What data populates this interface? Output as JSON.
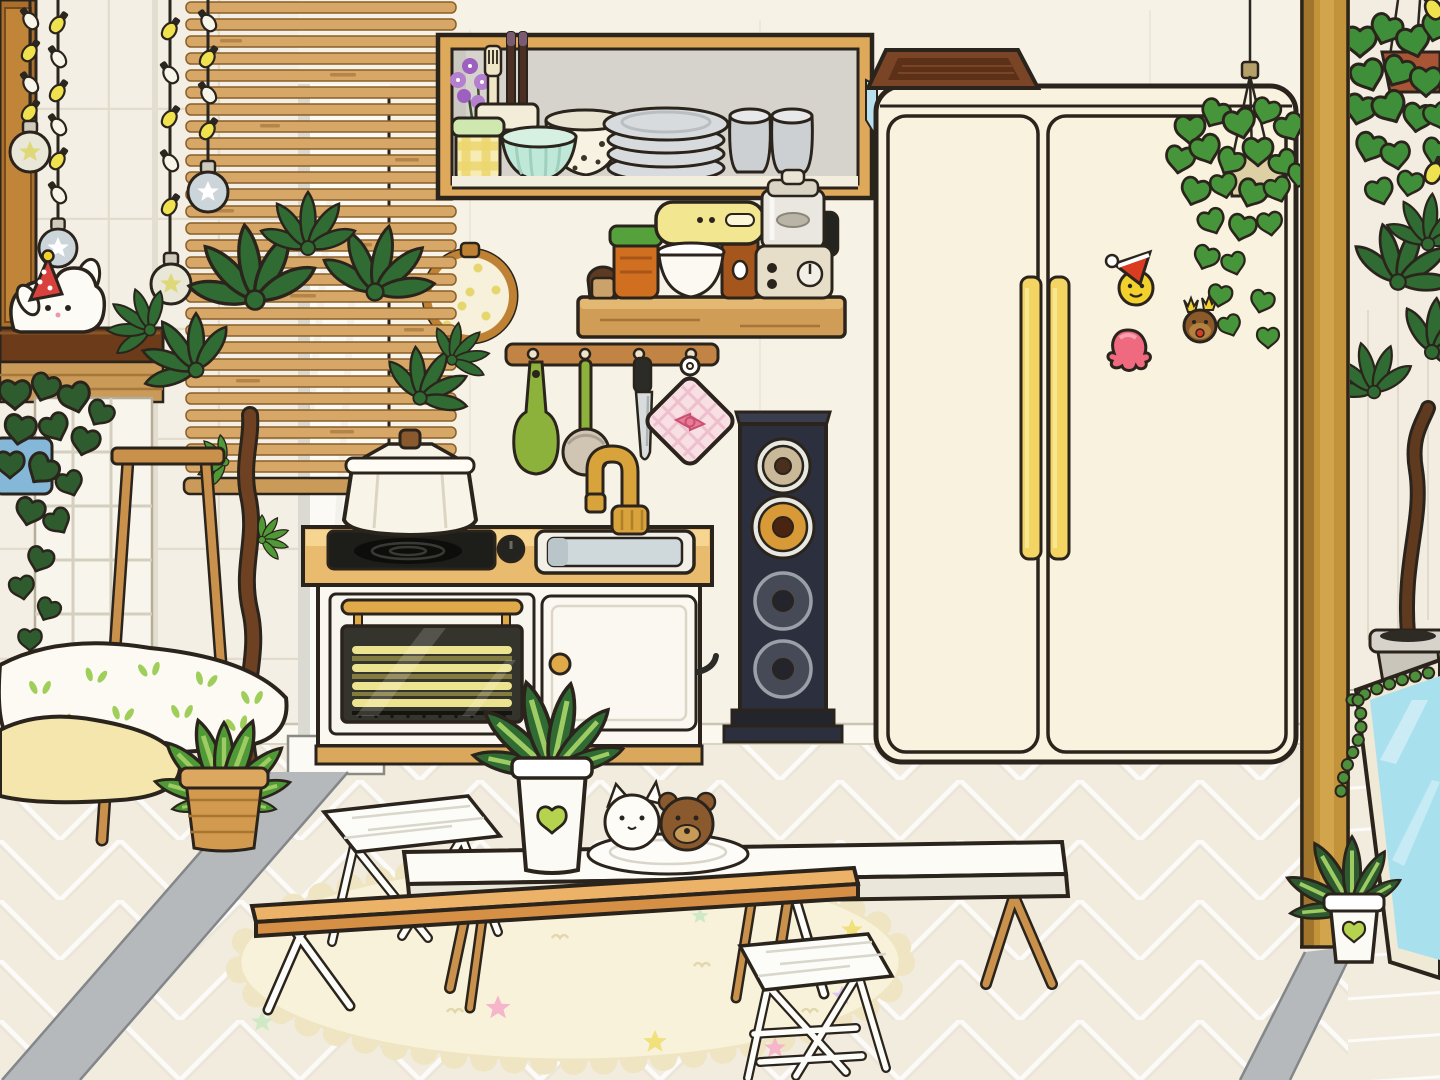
{
  "scene": {
    "title": "Toca-style cartoon kitchen room",
    "type": "game-room-scene",
    "visible_text": []
  },
  "objects": [
    {
      "name": "wood-cabinet-left",
      "desc": "tall wooden cabinet at far left"
    },
    {
      "name": "string-lights",
      "desc": "four hanging light strings with yellow and white bulbs"
    },
    {
      "name": "star-ornaments",
      "desc": "glass ball ornaments with star print"
    },
    {
      "name": "bunny-plush",
      "desc": "white bunny plush wearing red polka-dot party hat"
    },
    {
      "name": "bamboo-blind",
      "desc": "large slatted wooden blind"
    },
    {
      "name": "embroidery-hoop",
      "desc": "round hoop with dotted fabric behind blind"
    },
    {
      "name": "money-tree",
      "desc": "tall twisted-trunk plant with palmate leaves"
    },
    {
      "name": "ladder-stand",
      "desc": "wooden A-frame plant stand"
    },
    {
      "name": "blue-pot-vine",
      "desc": "trailing plant in blue pot"
    },
    {
      "name": "pillows",
      "desc": "white sprout-print pillow and yellow pillow"
    },
    {
      "name": "calathea",
      "desc": "striped-leaf plant in wicker basket"
    },
    {
      "name": "dish-shelf",
      "desc": "recessed wooden shelf with dishes"
    },
    {
      "name": "plate-stack",
      "desc": "stack of gray plates"
    },
    {
      "name": "tumblers",
      "desc": "two gray cups"
    },
    {
      "name": "teal-bowl",
      "desc": "mint fluted bowl"
    },
    {
      "name": "speckled-bowl",
      "desc": "cream speckled bowl"
    },
    {
      "name": "gingham-jar",
      "desc": "yellow checkered jar with mint lid"
    },
    {
      "name": "utensil-cup",
      "desc": "cup with fork and chopsticks"
    },
    {
      "name": "purple-flowers",
      "desc": "purple flower sprigs"
    },
    {
      "name": "appliance-shelf",
      "desc": "wall shelf with small appliances"
    },
    {
      "name": "stand-mixer",
      "desc": "yellow stand mixer with white bowl"
    },
    {
      "name": "food-processor",
      "desc": "glass food processor with dial"
    },
    {
      "name": "spice-jars",
      "desc": "small brown bottle and orange jar with green lid"
    },
    {
      "name": "utensil-rack",
      "desc": "wooden rail with hooks"
    },
    {
      "name": "green-spatula",
      "desc": "hanging green spatula"
    },
    {
      "name": "ladle",
      "desc": "hanging ladle with green handle"
    },
    {
      "name": "knife",
      "desc": "hanging kitchen knife"
    },
    {
      "name": "pot-holder",
      "desc": "pink gingham pot holder with bow"
    },
    {
      "name": "kitchen-counter",
      "desc": "small counter with cooktop, oven and sink"
    },
    {
      "name": "cooking-pot",
      "desc": "white pot with lid on the burner"
    },
    {
      "name": "gold-faucet",
      "desc": "gold gooseneck faucet"
    },
    {
      "name": "tower-speaker",
      "desc": "dark four-cone tower speaker"
    },
    {
      "name": "fridge",
      "desc": "cream double-door refrigerator with yellow handles"
    },
    {
      "name": "fridge-magnets",
      "desc": "santa smiley, strawberry and reindeer magnets"
    },
    {
      "name": "wood-tray",
      "desc": "dark wooden tray on top of fridge"
    },
    {
      "name": "hanging-ivy",
      "desc": "ivy in hanging pot beside fridge"
    },
    {
      "name": "wood-beam",
      "desc": "vertical wooden beam divider"
    },
    {
      "name": "hanging-pothos",
      "desc": "pothos in hanging terracotta pot, right room"
    },
    {
      "name": "leaning-mirror",
      "desc": "light-blue mirror leaning on right wall"
    },
    {
      "name": "string-of-beads",
      "desc": "bead plant draped over mirror"
    },
    {
      "name": "fern-pot",
      "desc": "small fern in white pot with lime heart"
    },
    {
      "name": "oval-rug",
      "desc": "cream scalloped rug with pastel stars"
    },
    {
      "name": "white-low-table",
      "desc": "long white low table on wooden legs"
    },
    {
      "name": "tan-low-table",
      "desc": "wooden low table in front"
    },
    {
      "name": "folding-stools",
      "desc": "two white folding stools"
    },
    {
      "name": "table-palm",
      "desc": "small palm in white heart pot on table"
    },
    {
      "name": "cookie-plate",
      "desc": "plate with cat and bear cookies"
    }
  ],
  "colors": {
    "ol": "#2b241c",
    "wall-kitchen": "#f7f2e6",
    "wall-tile": "#f3efe4",
    "tile-line": "#ded7c6",
    "wall-right": "#f2ede0",
    "wall-line": "#d8d2c2",
    "pillar": "#fbfaf5",
    "pillar-edge": "#dadad3",
    "gray-strip": "#b6b9bb",
    "gray-strip-edge": "#83878a",
    "floor": "#f2ecdf",
    "baseboard": "#fbf8ef",
    "blind-wood": "#d7a767",
    "blind-dash": "#b3854a",
    "blind-rail": "#c99a58",
    "shelf-wood": "#dfa95b",
    "shelf-int": "#d5d3cb",
    "shelf-floor": "#f3edde",
    "board-wood": "#cf9d55",
    "board-top": "#e3b872",
    "beam-wood": "#c2933a",
    "beam-dark": "#a1762c",
    "beam-light": "#d2a44c",
    "cabinet": "#c08539",
    "cabinet-dark": "#a96f2d",
    "dark-shelf": "#6b3b1a",
    "shelf-band": "#c99a58",
    "shoji": "#f8f5ec",
    "shoji-line": "#d5cfbf",
    "counter-top": "#f5d590",
    "counter-face": "#e9bb6f",
    "plinth": "#d9a85c",
    "unit-white": "#faf8f1",
    "door-line": "#ddd6c8",
    "oven-glass": "#34342c",
    "heat-rod": "#ece391",
    "heat-rod-dark": "#b7ad4e",
    "gold": "#e0aa4a",
    "cooktop": "#1d1e1a",
    "knob-black": "#23241f",
    "sink-rim": "#f2efe6",
    "sink-basin": "#cfd9dc",
    "faucet": "#d9a33c",
    "pot-white": "#f8f4e8",
    "knob-wood": "#8a5a2e",
    "speaker-navy": "#2c2f3e",
    "speaker-base": "#23242c",
    "speaker-beige": "#c9b998",
    "speaker-amber": "#d79a36",
    "speaker-dark": "#464a56",
    "silver": "#9aa0a8",
    "fridge": "#f8f2de",
    "handle-yellow": "#f4d564",
    "tray-brown": "#7a4426",
    "tray-dark": "#5d3118",
    "magnet-yellow": "#f2d12e",
    "magnet-red": "#d93c20",
    "berry-pink": "#ef6a7e",
    "deer-brown": "#8a5a2a",
    "deer-light": "#b5803f",
    "leaf-dark": "#2f6b33",
    "leaf-mid": "#4f9937",
    "leaf-light": "#9ecb62",
    "ivy-green": "#47953a",
    "pothos-green": "#3f8f3a",
    "vine-dark": "#2e5c2e",
    "fern-green": "#2d5a2f",
    "terracotta": "#a85535",
    "hang-pot": "#ddd0a4",
    "trunk": "#6e4122",
    "mirror-frame": "#efe9d6",
    "mirror-glass": "#a9e0ee",
    "gray-pot": "#d7d3ca",
    "lime": "#b5d34f",
    "rug": "#f9f2da",
    "rug-edge": "#efe5c3",
    "star-pink": "#f5b5cb",
    "star-yellow": "#f0e17c",
    "star-mint": "#cfe9c5",
    "star-lilac": "#dcc8ef",
    "bulb-yellow": "#f0e24e",
    "bulb-white": "#f7f4ea",
    "orn-glass": "#e9e7d8",
    "orn-blue": "#ccd5da",
    "star-gold": "#ded878",
    "bunny-white": "#fdfbf6",
    "hat-red": "#d9413c",
    "table-white": "#fcfbf6",
    "table-face": "#eae7da",
    "table-tan": "#ecb268",
    "table-tan-dark": "#d69046",
    "leg-wood": "#c9914b",
    "stool-white": "#fcfcf9",
    "pillow-white": "#fcfaf3",
    "pillow-yellow": "#f4e6ac",
    "sprout": "#9fcf5a",
    "blue-pot": "#85b8d8",
    "basket": "#d19a4f",
    "plate-gray": "#d8dbdd",
    "plate-line": "#b9bec2",
    "cup-gray": "#cdd0d2",
    "teal-bowl": "#bfe8d9",
    "teal-rim": "#d6f0e2",
    "speckle": "#f7f2e2",
    "jar-yellow": "#f6ecb4",
    "jar-check": "#ecd66e",
    "jar-lid-mint": "#cfe8b0",
    "flower-purple": "#b57fd0",
    "mixer-yellow": "#f2e690",
    "amber-col": "#a4561d",
    "jar-orange": "#cf6f1f",
    "jar-lid-green": "#55a23c",
    "glass-gray": "#e9e7e0",
    "proc-base": "#e6dec8",
    "ph-pink": "#f7dfe4",
    "ph-grid": "#eebccb",
    "bow-pink": "#e87a9a",
    "spatula": "#8db23c",
    "ladle": "#cfc5b2",
    "steel": "#d9dcdc",
    "hoop-wood": "#bf8134",
    "hoop-fabric": "#f7f0da",
    "hoop-dot": "#e5d66e",
    "window-blue": "#b9e0ef",
    "cookie-brown": "#8a5a2e",
    "cookie-light": "#c89a58",
    "white": "#ffffff"
  }
}
